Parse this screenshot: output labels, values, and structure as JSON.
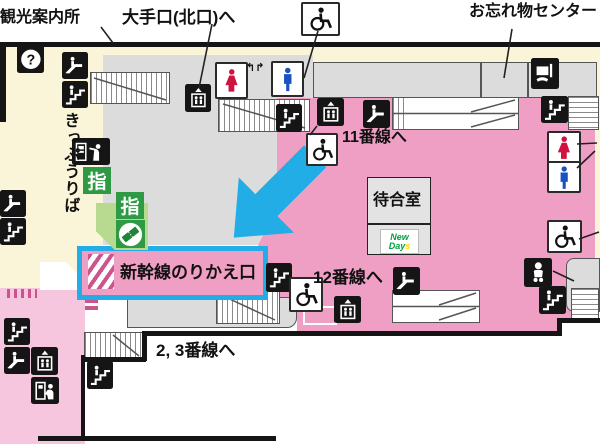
{
  "labels": {
    "tourist_info": "観光案内所",
    "ote_exit": "大手口(北口)へ",
    "lost_center": "お忘れ物センター",
    "ticket_office": "きっぷうりば",
    "track_11": "11番線へ",
    "track_12": "12番線へ",
    "track_2_3": "2, 3番線へ",
    "shinkansen_gate": "新幹線のりかえ口",
    "waiting_room": "待合室",
    "reserved_badge": "指",
    "question_mark": "?"
  },
  "newdays": {
    "line1": "New",
    "line2": "Day",
    "suffix": "s"
  },
  "colors": {
    "concourse_cream": "#faf5d8",
    "paid_pink": "#f09fc4",
    "corridor_pink": "#f5c6de",
    "structure_gray": "#dcdcdc",
    "highlight_cyan": "#22ade6",
    "sign_green": "#2e9b44",
    "female_red": "#cf1240",
    "male_blue": "#1a53c0",
    "stripe_pink": "#cb548f",
    "newdays_green": "#00a040",
    "newdays_yellow": "#ffd800"
  },
  "icon_names": [
    "information",
    "escalator",
    "stairs",
    "elevator",
    "wheelchair",
    "toilet-female",
    "toilet-male",
    "baby-room",
    "lost-items",
    "ticket-window",
    "ticket-machine-counter",
    "reserved-seat-ticket"
  ]
}
